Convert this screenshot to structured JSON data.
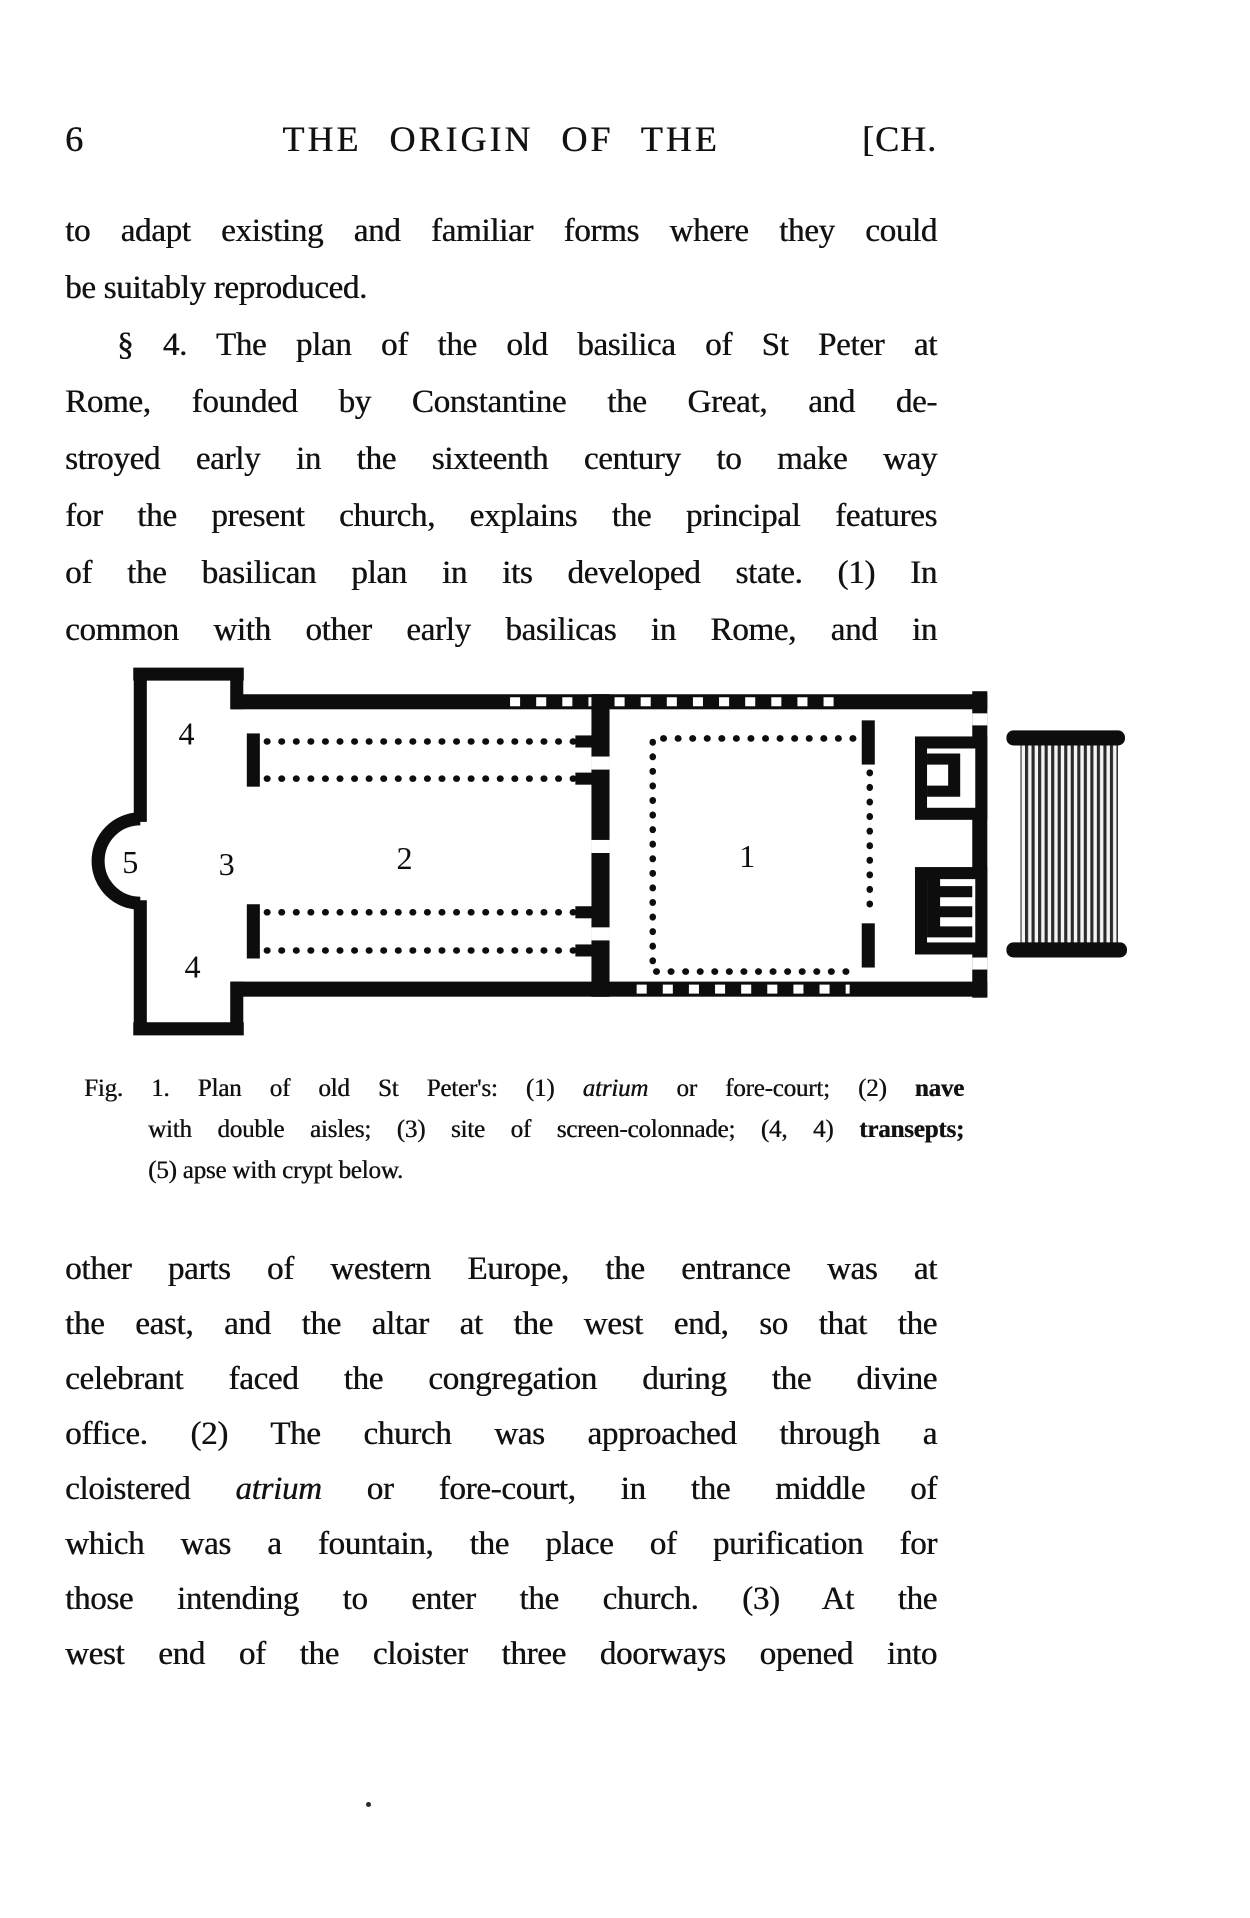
{
  "page": {
    "number": "6",
    "running_title": "THE ORIGIN OF THE",
    "chapter_mark": "[CH."
  },
  "paragraph1": {
    "lines": [
      "to adapt existing and familiar forms where they could",
      "be suitably reproduced."
    ]
  },
  "paragraph2": {
    "lines": [
      "§ 4.  The plan of the old basilica of St Peter at",
      "Rome, founded by Constantine the Great, and de-",
      "stroyed early in the sixteenth century to make way",
      "for the present church, explains the principal features",
      "of the basilican plan in its developed state.  (1) In",
      "common with other early basilicas in Rome, and in"
    ]
  },
  "figure": {
    "labels": {
      "atrium": "1",
      "nave": "2",
      "screen_colonnade": "3",
      "transept_north": "4",
      "transept_south": "4",
      "apse": "5"
    }
  },
  "caption": {
    "line1_pre": "Fig. 1.   Plan of old St Peter's: (1) ",
    "line1_italic": "atrium",
    "line1_mid": " or fore-court; (2) ",
    "line1_bold": "nave",
    "line2_pre": "with double aisles; (3) site of screen-colonnade; (4, 4) ",
    "line2_bold": "transepts;",
    "line3": "(5) apse with crypt below."
  },
  "paragraph3": {
    "lines_a": [
      "other parts of western Europe, the entrance was at",
      "the east, and the altar at the west end, so that the",
      "celebrant faced the congregation during the divine",
      "office.  (2)  The church was approached through a"
    ],
    "line5_pre": "cloistered ",
    "line5_italic": "atrium",
    "line5_post": " or fore-court, in the middle of",
    "lines_b": [
      "which was a fountain, the place of purification for",
      "those intending to enter the church.  (3)  At the",
      "west end of the cloister three doorways opened into"
    ]
  }
}
